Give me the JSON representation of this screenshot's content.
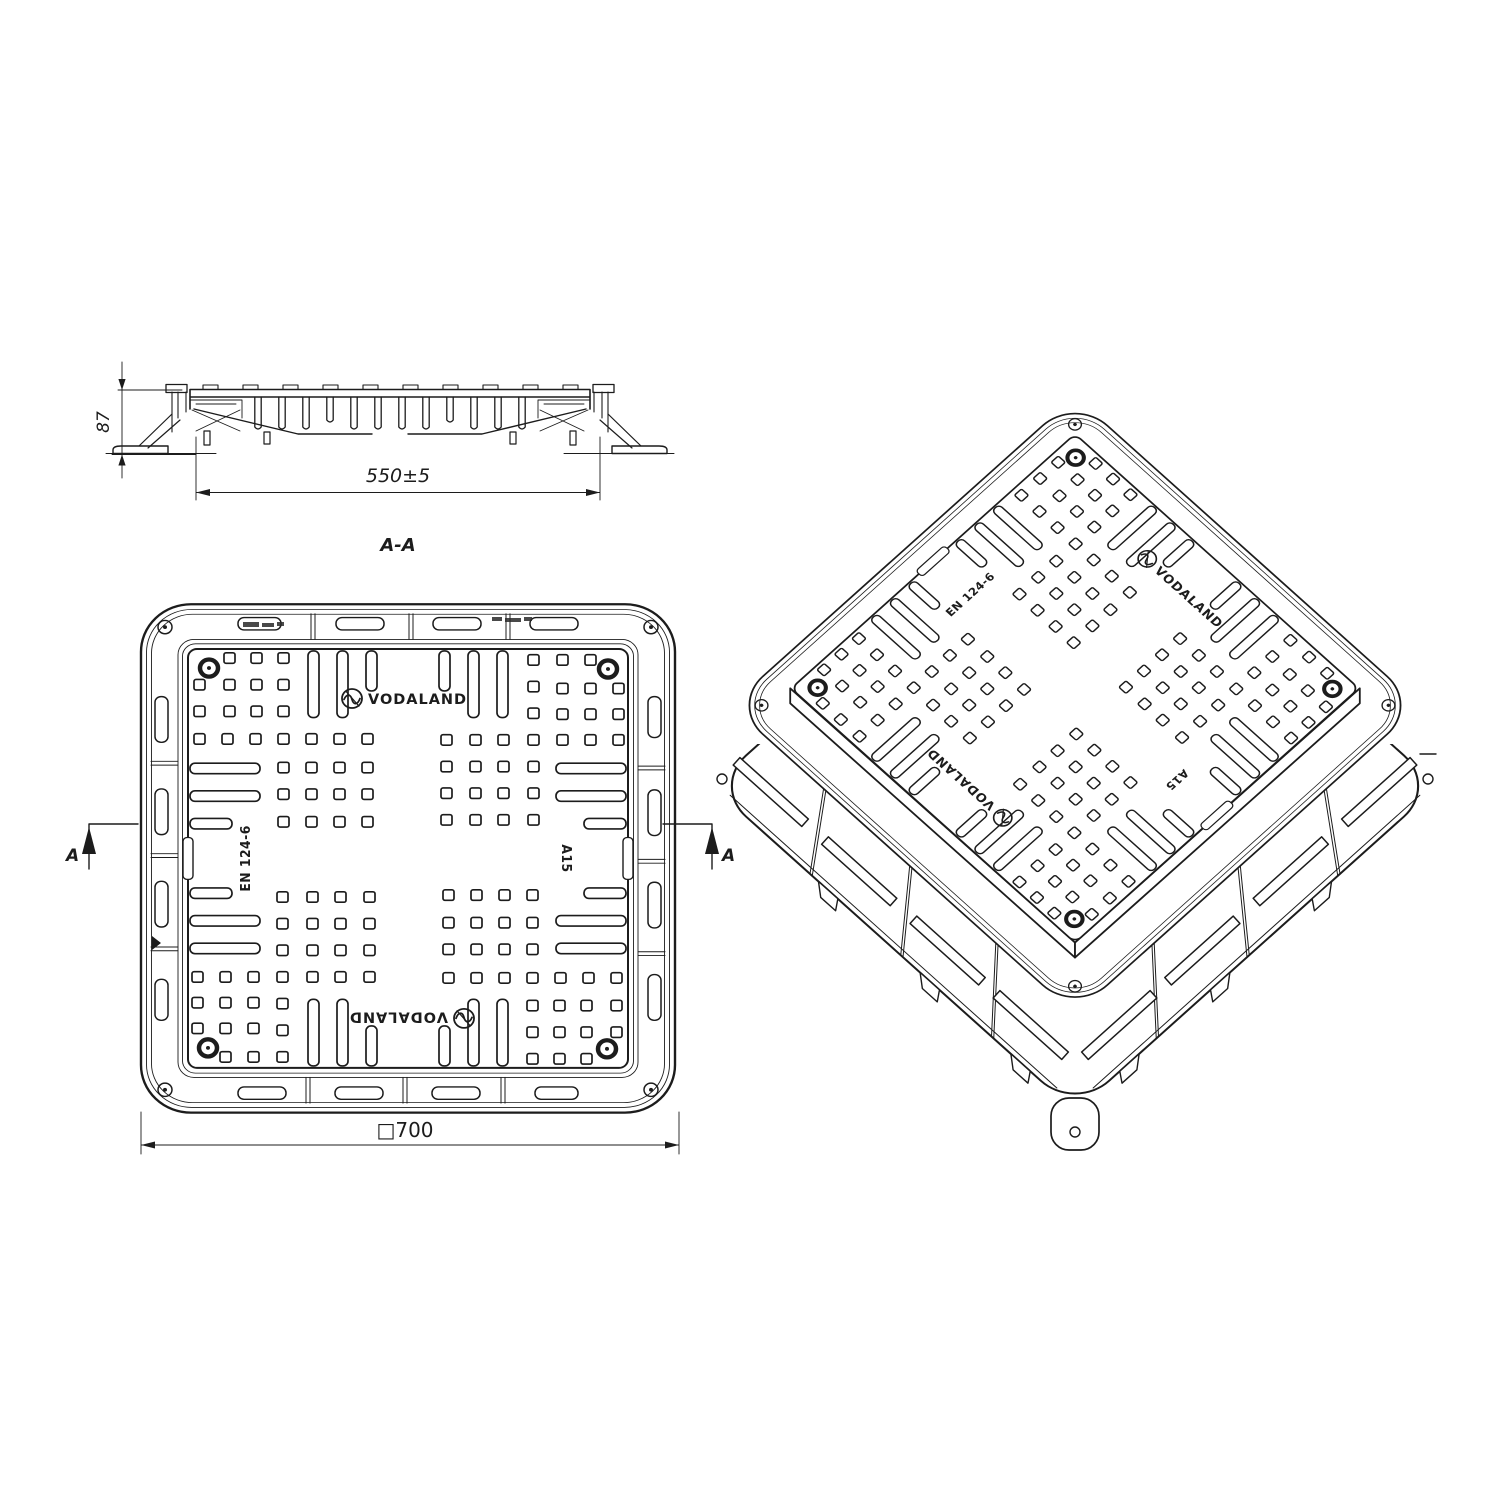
{
  "views": {
    "section": {
      "title": "A-A",
      "height_dim": "87",
      "width_dim": "550±5",
      "cut_arrow_label": "A"
    },
    "plan": {
      "overall_dim": "□700"
    },
    "markings": {
      "brand": "VODALAND",
      "standard": "EN 124-6",
      "load_class": "A15"
    }
  },
  "colors": {
    "line": "#1c1c1c",
    "background": "#ffffff"
  }
}
